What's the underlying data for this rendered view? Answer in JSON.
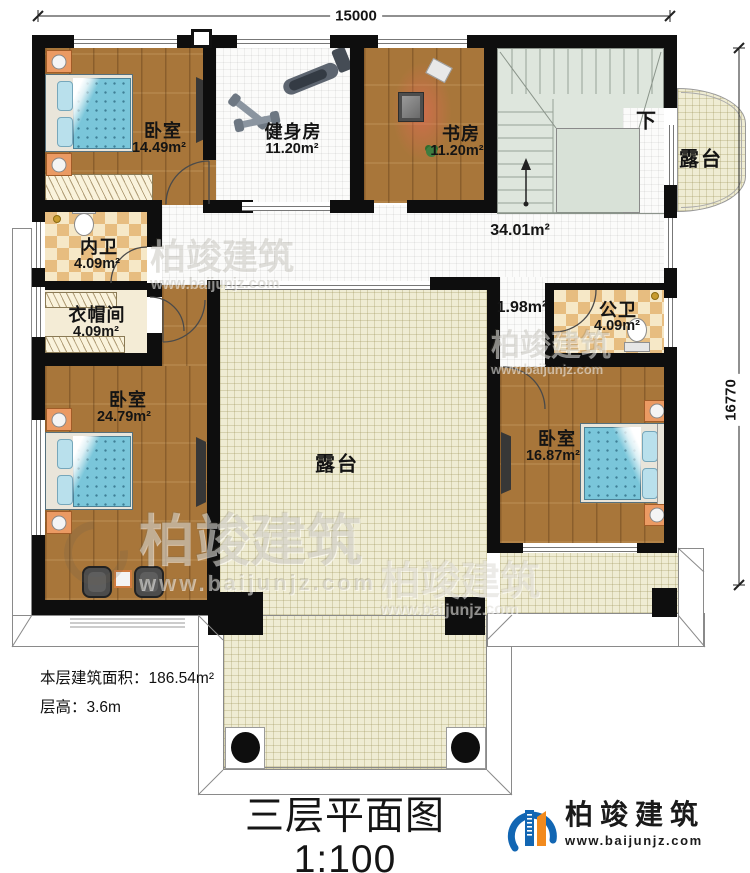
{
  "plan": {
    "dim_top": "15000",
    "dim_right": "16770",
    "stairs_down": "下",
    "rooms": {
      "bedroom_tl": {
        "name": "卧室",
        "area": "14.49m²"
      },
      "gym": {
        "name": "健身房",
        "area": "11.20m²"
      },
      "study": {
        "name": "书房",
        "area": "11.20m²"
      },
      "terrace_side": {
        "name": "露台"
      },
      "hall": {
        "area": "34.01m²"
      },
      "bath_inner": {
        "name": "内卫",
        "area": "4.09m²"
      },
      "cloakroom": {
        "name": "衣帽间",
        "area": "4.09m²"
      },
      "bedroom_bl": {
        "name": "卧室",
        "area": "24.79m²"
      },
      "corridor": {
        "area": "1.98m²"
      },
      "bath_public": {
        "name": "公卫",
        "area": "4.09m²"
      },
      "bedroom_br": {
        "name": "卧室",
        "area": "16.87m²"
      },
      "terrace_center": {
        "name": "露台"
      }
    }
  },
  "info": {
    "floor_area": "本层建筑面积：186.54m²",
    "floor_height": "层高：3.6m"
  },
  "title": {
    "name": "三层平面图",
    "scale": "1:100"
  },
  "brand": {
    "name": "柏竣建筑",
    "url": "www.baijunjz.com"
  },
  "watermark": {
    "name": "柏竣建筑",
    "url": "www.baijunjz.com"
  },
  "colors": {
    "wall": "#0e0e0e",
    "wood": "#a8763a",
    "tile": "#fbfbfa",
    "terrace": "#efecd3",
    "stairs": "#dee6dd",
    "checker": "#e7bd80",
    "bed_blue": "#7ac6da",
    "logo_blue": "#1266b3",
    "logo_orange": "#f28a1d"
  }
}
